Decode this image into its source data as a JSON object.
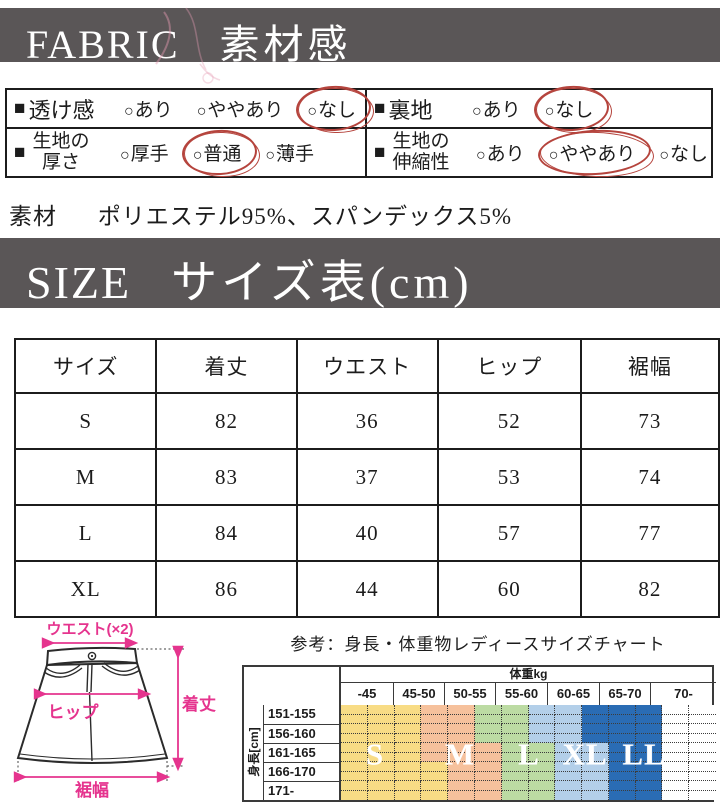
{
  "fabric": {
    "header_en": "FABRIC",
    "header_ja": "素材感",
    "bullet": "■",
    "option_mark": "○",
    "cells": [
      {
        "label_lines": [
          "透け感"
        ],
        "options": [
          {
            "text": "あり",
            "circled": false
          },
          {
            "text": "ややあり",
            "circled": false
          },
          {
            "text": "なし",
            "circled": true
          }
        ]
      },
      {
        "label_lines": [
          "裏地"
        ],
        "options": [
          {
            "text": "あり",
            "circled": false
          },
          {
            "text": "なし",
            "circled": true
          }
        ]
      },
      {
        "label_lines": [
          "生地の",
          "厚さ"
        ],
        "options": [
          {
            "text": "厚手",
            "circled": false
          },
          {
            "text": "普通",
            "circled": true
          },
          {
            "text": "薄手",
            "circled": false
          }
        ]
      },
      {
        "label_lines": [
          "生地の",
          "伸縮性"
        ],
        "options": [
          {
            "text": "あり",
            "circled": false
          },
          {
            "text": "ややあり",
            "circled": true
          },
          {
            "text": "なし",
            "circled": false
          }
        ]
      }
    ]
  },
  "material": {
    "label": "素材",
    "value": "ポリエステル95%、スパンデックス5%"
  },
  "size": {
    "header_en": "SIZE",
    "header_ja": "サイズ表(cm)",
    "columns": [
      "サイズ",
      "着丈",
      "ウエスト",
      "ヒップ",
      "裾幅"
    ],
    "rows": [
      [
        "S",
        "82",
        "36",
        "52",
        "73"
      ],
      [
        "M",
        "83",
        "37",
        "53",
        "74"
      ],
      [
        "L",
        "84",
        "40",
        "57",
        "77"
      ],
      [
        "XL",
        "86",
        "44",
        "60",
        "82"
      ]
    ]
  },
  "diagram": {
    "waist_label": "ウエスト(×2)",
    "hip_label": "ヒップ",
    "length_label": "着丈",
    "hem_label": "裾幅",
    "accent_color": "#e5348e"
  },
  "reference": {
    "title": "参考：身長・体重物レディースサイズチャート",
    "weight_header": "体重kg",
    "weight_columns": [
      "-45",
      "45-50",
      "50-55",
      "55-60",
      "60-65",
      "65-70",
      "70-"
    ],
    "height_label": "身長[cm]",
    "height_rows": [
      "151-155",
      "156-160",
      "161-165",
      "166-170",
      "171-"
    ],
    "size_letters": [
      {
        "text": "S",
        "x": 36
      },
      {
        "text": "M",
        "x": 121
      },
      {
        "text": "L",
        "x": 190
      },
      {
        "text": "XL",
        "x": 246
      },
      {
        "text": "LL",
        "x": 305
      }
    ],
    "palette": {
      "Y": "#f8dc85",
      "O": "#f6c19c",
      "G": "#bcdba3",
      "B": "#b3cfe9",
      "D": "#2a6cb4",
      "W": "#ffffff"
    },
    "grid_rows": [
      "YYYOOGGBBDDDWW",
      "YYYOOGGBBDDDWW",
      "YYYOOOGGBBDDWW",
      "YYYYOOGGBBDDWW",
      "YYYYOOGGBBDDWW"
    ]
  },
  "colors": {
    "bar_bg": "#5a5657",
    "bar_text": "#ffffff",
    "circle_red": "#b5443d",
    "outline": "#1c1c1c"
  }
}
